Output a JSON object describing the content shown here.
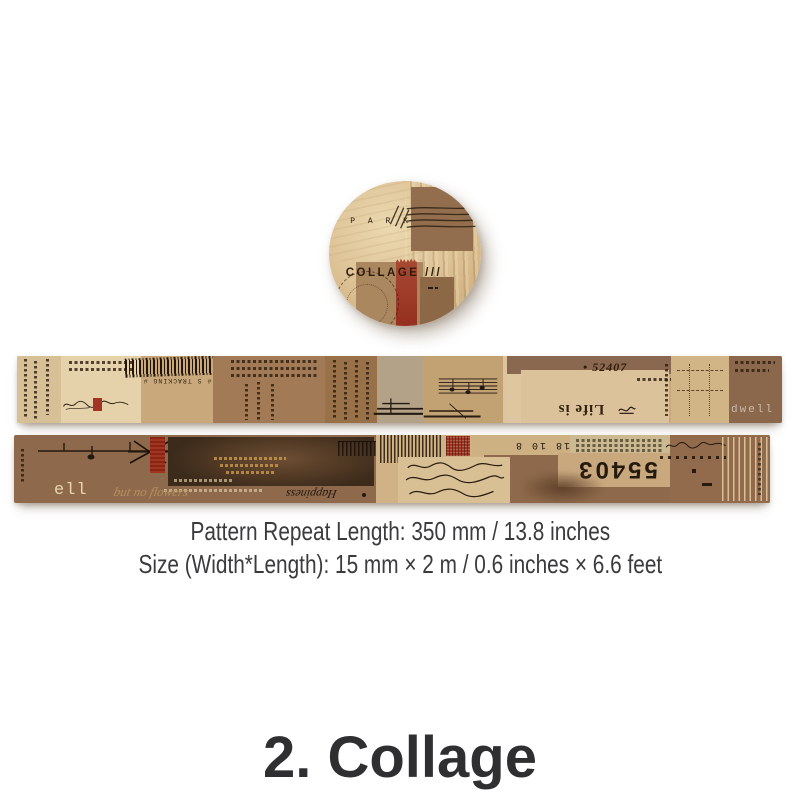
{
  "product": {
    "spec_line1": "Pattern Repeat Length: 350 mm / 13.8 inches",
    "spec_line2": "Size (Width*Length): 15 mm × 2 m / 0.6 inches × 6.6 feet",
    "title": "2. Collage"
  },
  "roll": {
    "collage_label": "COLLAGE ///",
    "park_label": "P A R K"
  },
  "strip1": {
    "tracking_label": "# S TRACKING #",
    "serial_number": "• 52407",
    "life_is": "Life is",
    "dwell": "dwell"
  },
  "strip2": {
    "ell": "ell",
    "script_flowers": "but no flowers",
    "script_happiness": "Happiness",
    "small_numbers": "18 10 8",
    "big_numbers": "55403"
  },
  "colors": {
    "background": "#ffffff",
    "cream_paper": "#e4d0a8",
    "tan_paper": "#c9a87c",
    "kraft_brown": "#9b7452",
    "mid_brown": "#8a6548",
    "dark_brown": "#46321f",
    "stamp_red": "#a13a28",
    "body_text": "#3b3b3d"
  }
}
